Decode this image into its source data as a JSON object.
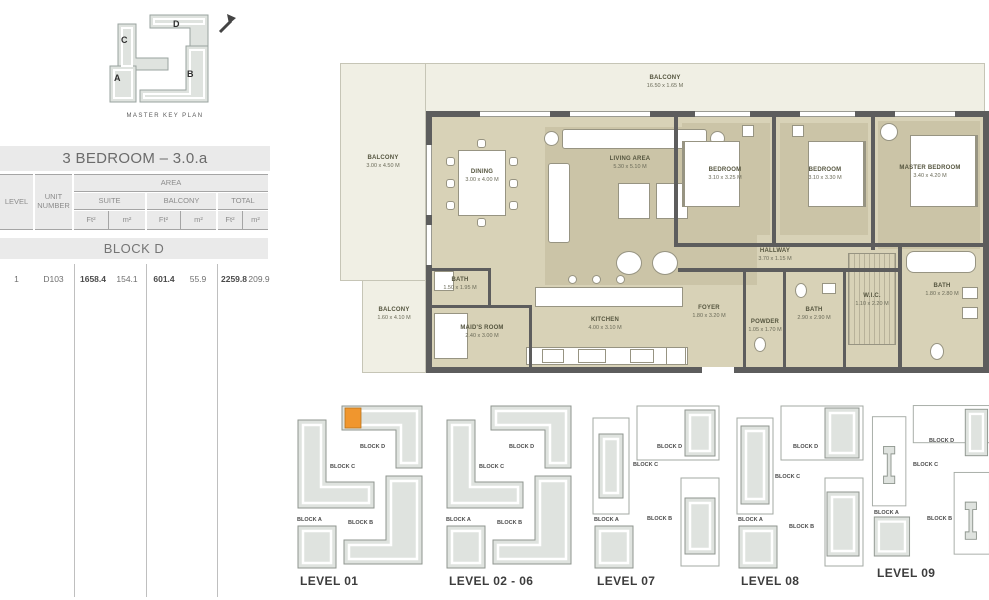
{
  "key_plan": {
    "caption": "MASTER KEY PLAN",
    "block_letters": {
      "a": "A",
      "b": "B",
      "c": "C",
      "d": "D"
    }
  },
  "title": "3 BEDROOM – 3.0.a",
  "table": {
    "headers": {
      "level": "LEVEL",
      "unit_number": "UNIT NUMBER",
      "area": "AREA",
      "suite": "SUITE",
      "balcony": "BALCONY",
      "total": "TOTAL",
      "ft2": "Ft²",
      "m2": "m²"
    },
    "block_header": "BLOCK D",
    "row": {
      "level": "1",
      "unit": "D103",
      "suite_ft2": "1658.4",
      "suite_m2": "154.1",
      "balcony_ft2": "601.4",
      "balcony_m2": "55.9",
      "total_ft2": "2259.8",
      "total_m2": "209.9"
    }
  },
  "floor_plan": {
    "rooms": {
      "balcony_top": {
        "name": "BALCONY",
        "dims": "16.50 x 1.65 M"
      },
      "balcony_left": {
        "name": "BALCONY",
        "dims": "3.00 x 4.50 M"
      },
      "balcony_bottom": {
        "name": "BALCONY",
        "dims": "1.60 x 4.10 M"
      },
      "dining": {
        "name": "DINING",
        "dims": "3.00 x 4.00 M"
      },
      "living": {
        "name": "LIVING AREA",
        "dims": "5.30 x 5.10 M"
      },
      "bedroom1": {
        "name": "BEDROOM",
        "dims": "3.10 x 3.25 M"
      },
      "bedroom2": {
        "name": "BEDROOM",
        "dims": "3.10 x 3.30 M"
      },
      "master_bedroom": {
        "name": "MASTER BEDROOM",
        "dims": "3.40 x 4.20 M"
      },
      "hallway": {
        "name": "HALLWAY",
        "dims": "3.70 x 1.15 M"
      },
      "bath1": {
        "name": "BATH",
        "dims": "1.50 x 1.95 M"
      },
      "maids_room": {
        "name": "MAID'S ROOM",
        "dims": "2.40 x 3.00 M"
      },
      "kitchen": {
        "name": "KITCHEN",
        "dims": "4.00 x 3.10 M"
      },
      "foyer": {
        "name": "FOYER",
        "dims": "1.80 x 3.20 M"
      },
      "powder": {
        "name": "POWDER",
        "dims": "1.05 x 1.70 M"
      },
      "bath2": {
        "name": "BATH",
        "dims": "2.90 x 2.90 M"
      },
      "wic": {
        "name": "W.I.C.",
        "dims": "1.10 x 2.20 M"
      },
      "bath3": {
        "name": "BATH",
        "dims": "1.80 x 2.80 M"
      }
    }
  },
  "levels": {
    "block_labels": {
      "a": "BLOCK A",
      "b": "BLOCK B",
      "c": "BLOCK C",
      "d": "BLOCK D"
    },
    "items": [
      {
        "label": "LEVEL 01"
      },
      {
        "label": "LEVEL 02 - 06"
      },
      {
        "label": "LEVEL 07"
      },
      {
        "label": "LEVEL 08"
      },
      {
        "label": "LEVEL 09"
      }
    ]
  },
  "colors": {
    "highlight_unit": "#F0962E",
    "unit_floor": "#D8D2B7",
    "balcony_fill": "#F0EFE4",
    "wall": "#5D5D5D",
    "header_bar": "#EAEAEA"
  }
}
